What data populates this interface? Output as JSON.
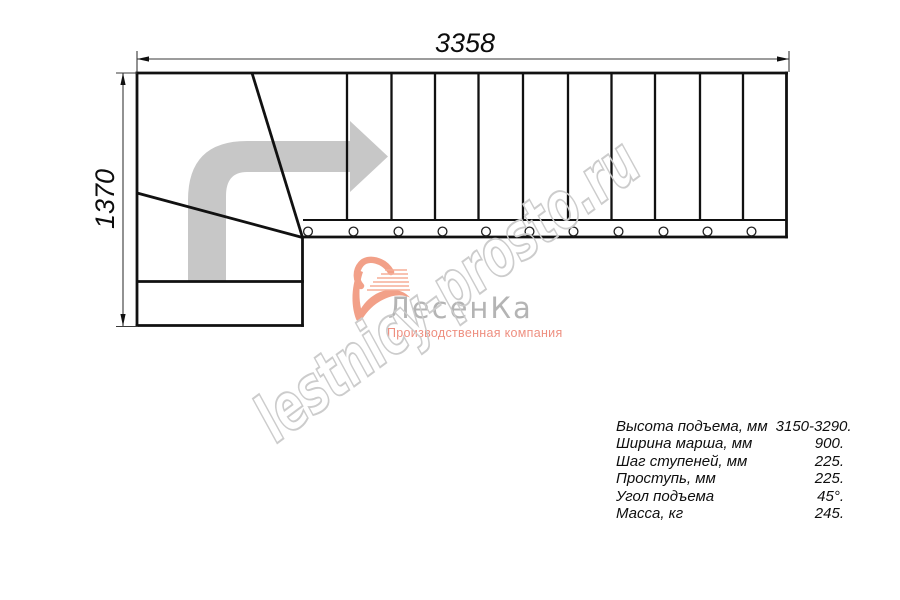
{
  "title": "Staircase plan drawing",
  "dimensions": {
    "width_mm": "3358",
    "height_mm": "1370"
  },
  "watermark": {
    "text": "lestnicy-prosto.ru"
  },
  "logo": {
    "name": "ЛесенКа",
    "tagline": "Производственная компания"
  },
  "specs": {
    "rows": [
      {
        "label": "Высота подъема, мм",
        "value": "3150-3290."
      },
      {
        "label": "Ширина марша, мм",
        "value": "900."
      },
      {
        "label": "Шаг ступеней, мм",
        "value": "225."
      },
      {
        "label": "Проступь, мм",
        "value": "225."
      },
      {
        "label": "Угол подъема",
        "value": "45°."
      },
      {
        "label": "Масса, кг",
        "value": "245."
      }
    ]
  },
  "colors": {
    "line": "#111111",
    "dimension_line": "#3a3a3a",
    "arrow_gray": "#c7c7c7",
    "watermark_gray": "#cccccc",
    "logo_gray": "#b4b4b4",
    "logo_salmon": "#f2a088"
  }
}
